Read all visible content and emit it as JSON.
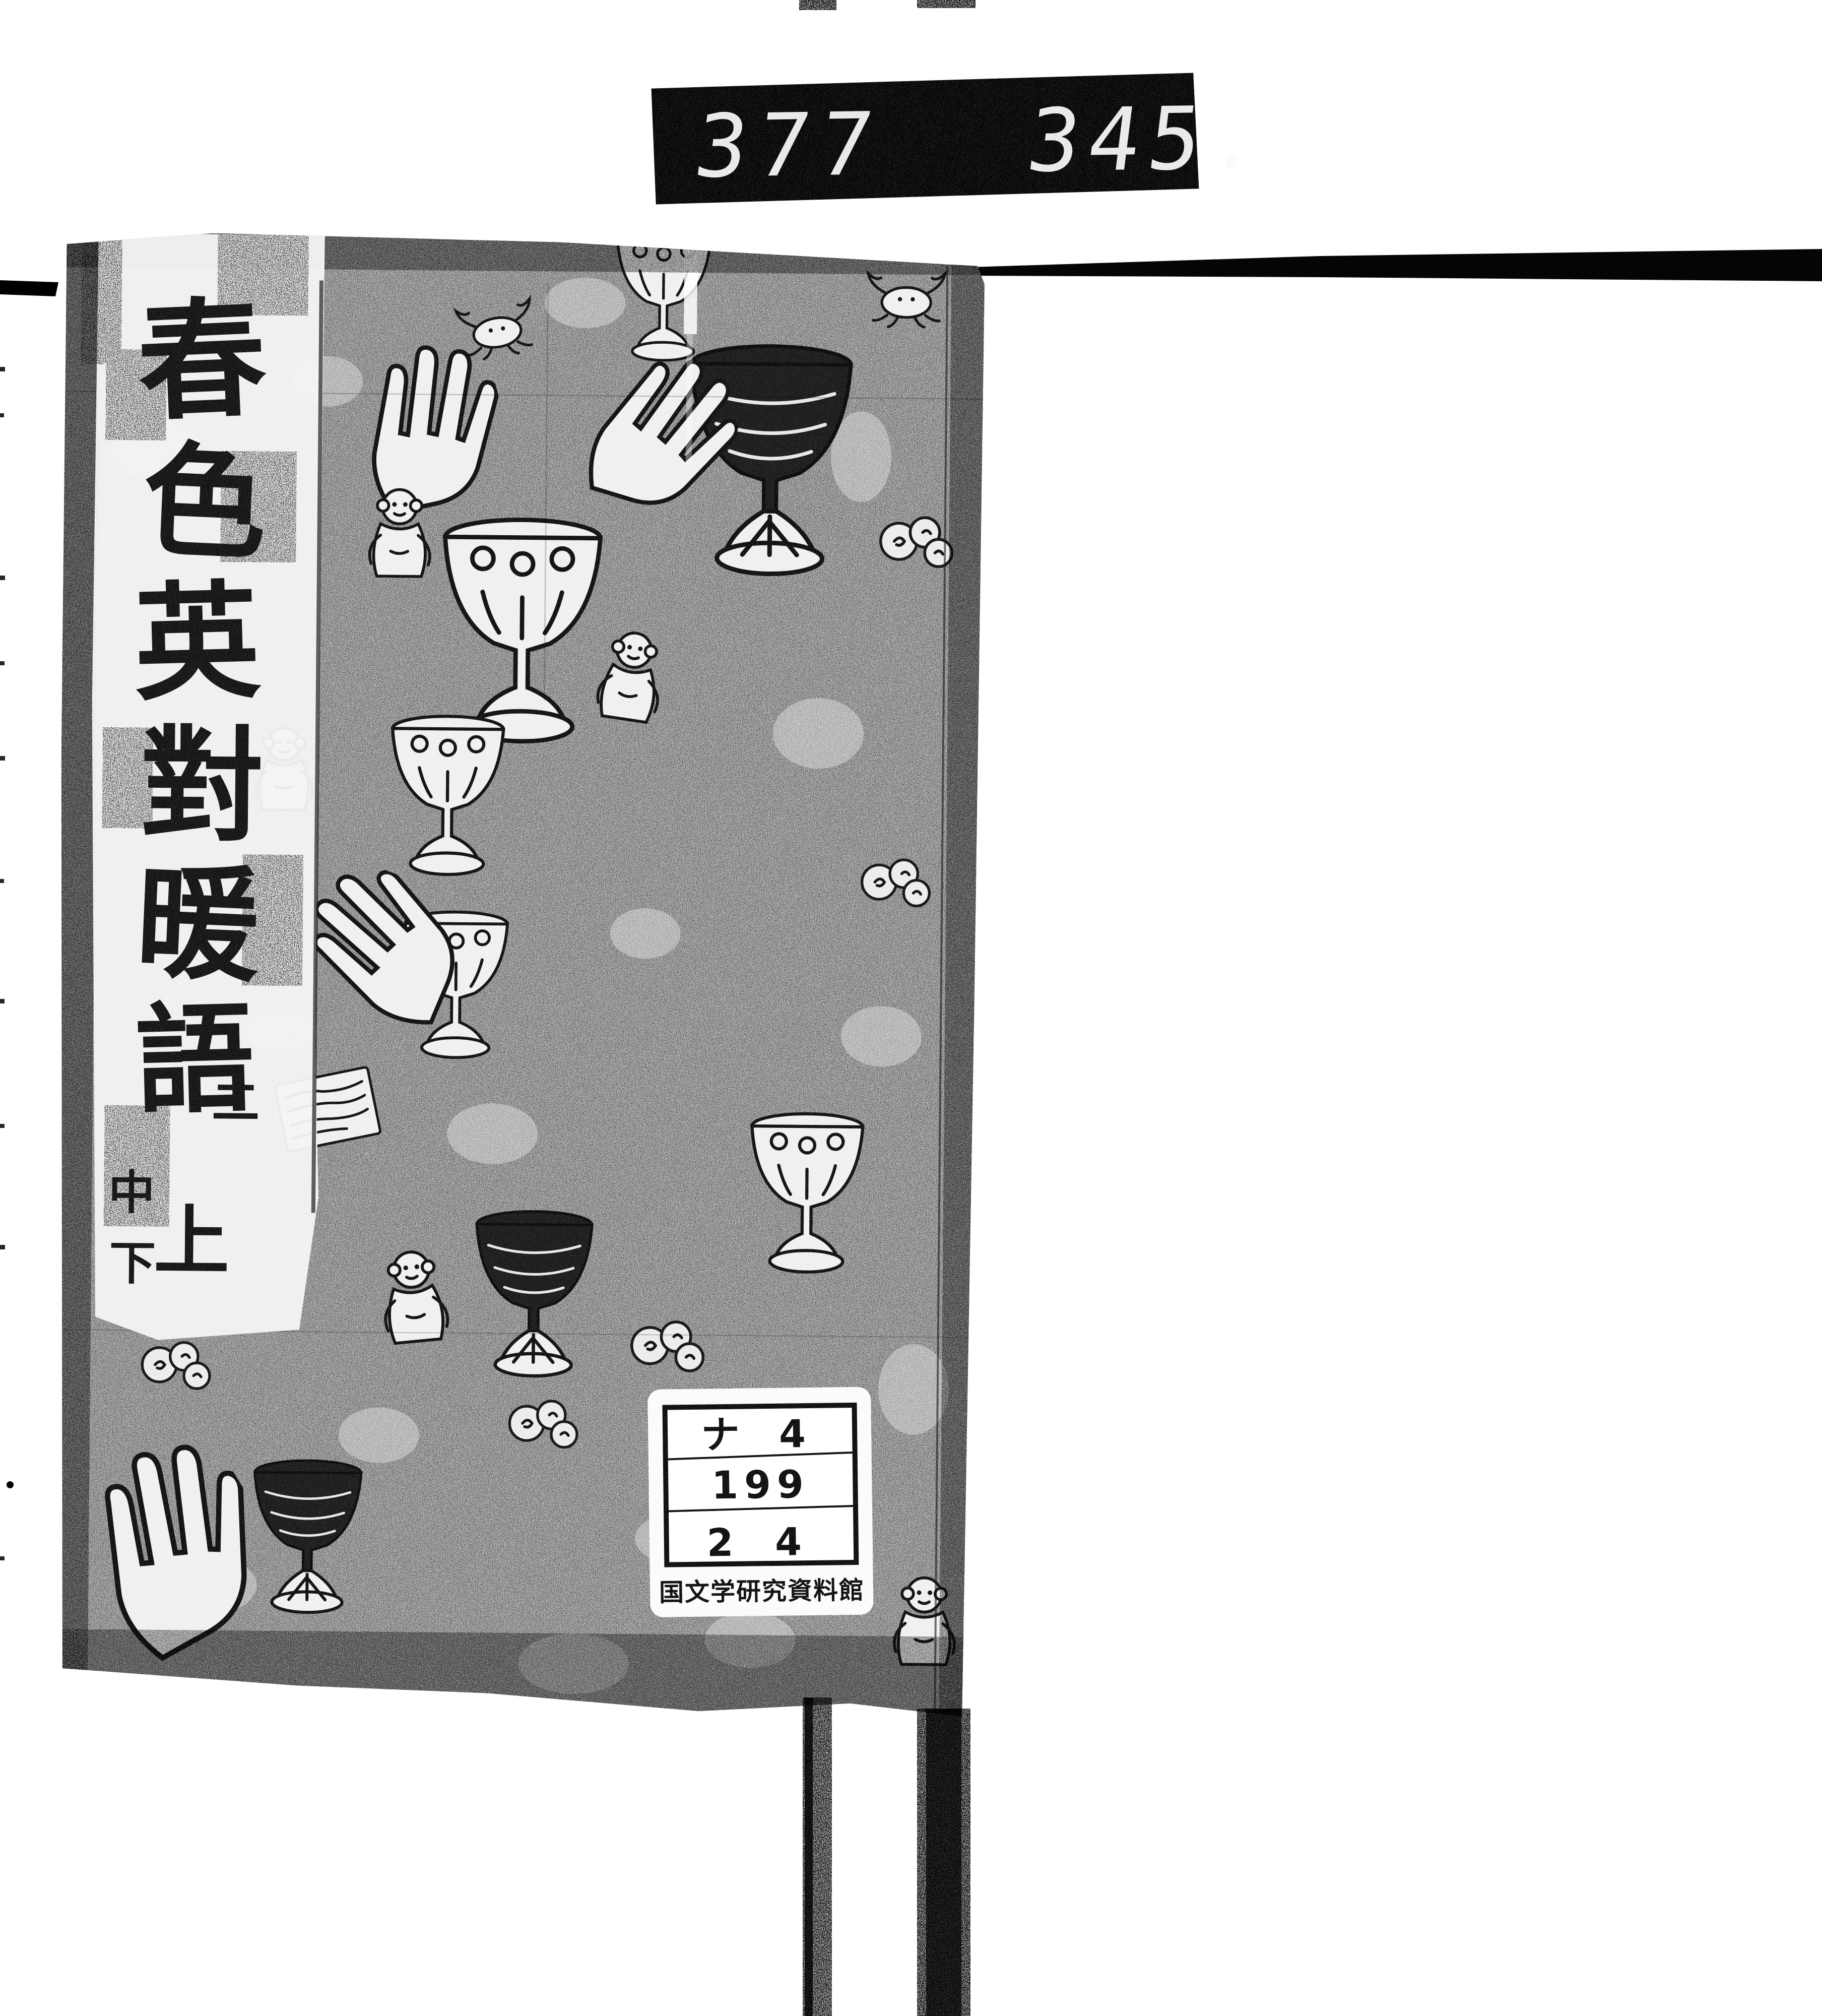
{
  "scan": {
    "counter": {
      "left_digits": "377",
      "right_digits": "345."
    },
    "cover": {
      "title_vertical": "春色英對暖語",
      "title_chars": [
        "春",
        "色",
        "英",
        "對",
        "暖",
        "語"
      ],
      "volume": {
        "series": "二",
        "upper": "上",
        "middle": "中",
        "lower": "下"
      },
      "pattern_motifs": [
        "goblet-icon",
        "goblet-dark-icon",
        "hand-icon",
        "monkey-icon",
        "crab-icon",
        "letter-scroll-icon",
        "scroll-flower-icon"
      ]
    },
    "label": {
      "rows": [
        "ナ 4",
        "199",
        "2 4"
      ],
      "institute": "国文学研究資料館"
    },
    "colors": {
      "ink": "#000000",
      "paper": "#ffffff",
      "cover_gray": "#b2b2b2",
      "label_paper": "#fbfbfb"
    }
  }
}
